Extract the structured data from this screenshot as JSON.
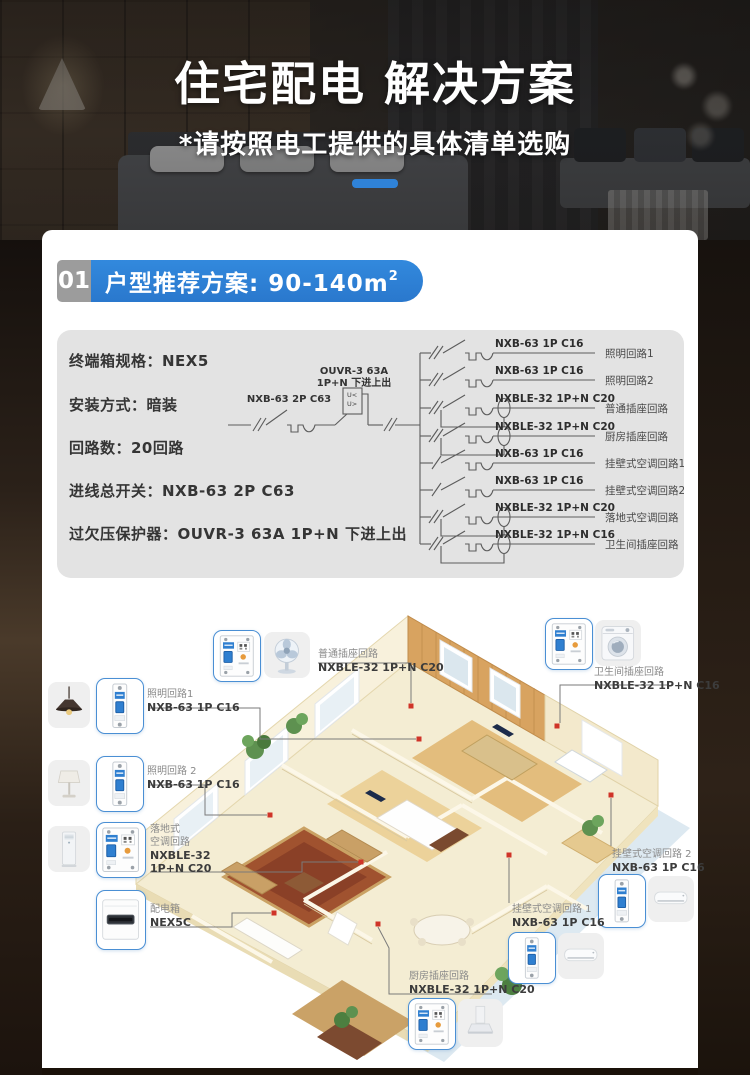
{
  "hero": {
    "title": "住宅配电 解决方案",
    "subtitle": "*请按照电工提供的具体清单选购"
  },
  "section": {
    "number": "01",
    "title": "户型推荐方案: 90-140m",
    "sup": "2"
  },
  "specs": [
    "终端箱规格：NEX5",
    "安装方式：暗装",
    "回路数：20回路",
    "进线总开关：NXB-63 2P C63",
    "过欠压保护器：OUVR-3 63A 1P+N 下进上出"
  ],
  "diagram": {
    "main_breaker": "NXB-63 2P C63",
    "ouvr1": "OUVR-3 63A",
    "ouvr2": "1P+N 下进上出",
    "u_lt": "U<",
    "u_gt": "U>",
    "branches": [
      {
        "model": "NXB-63 1P C16",
        "circuit": "照明回路1",
        "type": "mcb"
      },
      {
        "model": "NXB-63 1P C16",
        "circuit": "照明回路2",
        "type": "mcb"
      },
      {
        "model": "NXBLE-32 1P+N C20",
        "circuit": "普通插座回路",
        "type": "rcbo"
      },
      {
        "model": "NXBLE-32 1P+N C20",
        "circuit": "厨房插座回路",
        "type": "rcbo"
      },
      {
        "model": "NXB-63 1P C16",
        "circuit": "挂壁式空调回路1",
        "type": "mcb"
      },
      {
        "model": "NXB-63 1P C16",
        "circuit": "挂壁式空调回路2",
        "type": "mcb"
      },
      {
        "model": "NXBLE-32 1P+N C20",
        "circuit": "落地式空调回路",
        "type": "rcbo"
      },
      {
        "model": "NXBLE-32 1P+N C16",
        "circuit": "卫生间插座回路",
        "type": "rcbo"
      }
    ]
  },
  "callouts": {
    "general": {
      "name": "普通插座回路",
      "model": "NXBLE-32 1P+N C20"
    },
    "bathroom": {
      "name": "卫生间插座回路",
      "model": "NXBLE-32 1P+N C16"
    },
    "lighting1": {
      "name": "照明回路1",
      "model": "NXB-63 1P C16"
    },
    "lighting2": {
      "name": "照明回路 2",
      "model": "NXB-63 1P C16"
    },
    "floor_ac": {
      "name_l1": "落地式",
      "name_l2": "空调回路",
      "model_l1": "NXBLE-32",
      "model_l2": "1P+N C20"
    },
    "dist_box": {
      "name": "配电箱",
      "model": "NEX5C"
    },
    "wall_ac2": {
      "name": "挂壁式空调回路 2",
      "model": "NXB-63 1P C16"
    },
    "wall_ac1": {
      "name": "挂壁式空调回路 1",
      "model": "NXB-63 1P C16"
    },
    "kitchen": {
      "name": "厨房插座回路",
      "model": "NXBLE-32 1P+N C20"
    }
  },
  "icons": {
    "breaker_1p": "miniature-circuit-breaker-1P",
    "breaker_1pn": "residual-current-breaker-1P+N",
    "fan": "desk-fan",
    "washer": "washing-machine",
    "pendant_lamp": "pendant-lamp",
    "table_lamp": "table-lamp",
    "floor_ac": "floor-standing-air-conditioner",
    "wall_ac": "wall-mounted-air-conditioner",
    "range_hood": "range-hood",
    "dist_box": "distribution-box"
  },
  "colors": {
    "accent_blue": "#2f82d8",
    "pill_blue": "#2a78cd",
    "panel_gray": "#e3e3e3",
    "tile_border_blue": "#4a8fd4",
    "dot_red": "#cf3428"
  }
}
